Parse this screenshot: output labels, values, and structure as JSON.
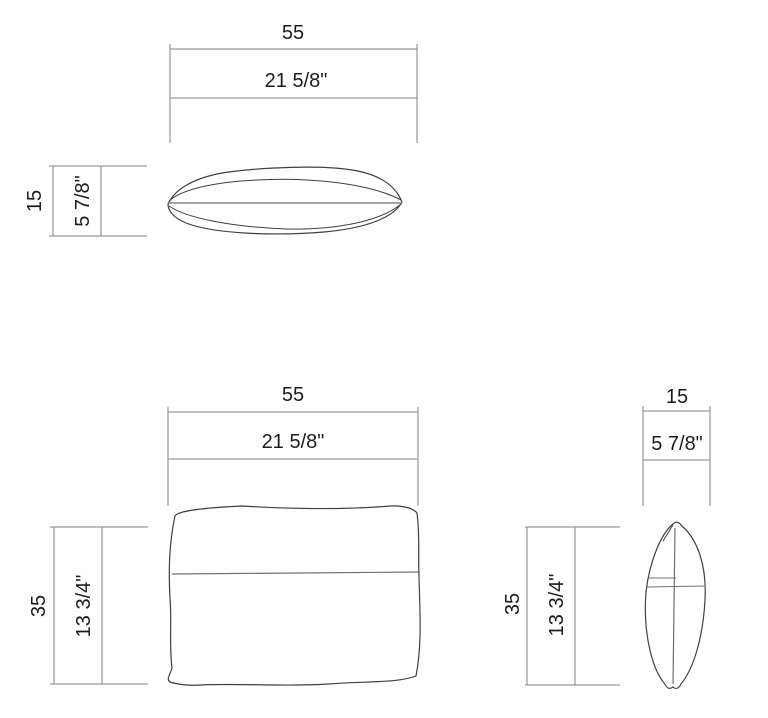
{
  "drawing": {
    "type": "technical-dimension-drawing",
    "subject": "rectangular cushion shown in top, front and side views",
    "colors": {
      "background": "#ffffff",
      "dimension_line": "#828282",
      "outline": "#404040",
      "seam_line": "#6f6f6f",
      "text": "#1c1c1c"
    },
    "views": {
      "top": {
        "name": "top view",
        "width_cm": "55",
        "width_in": "21 5/8\"",
        "depth_cm": "15",
        "depth_in": "5 7/8\""
      },
      "front": {
        "name": "front view",
        "width_cm": "55",
        "width_in": "21 5/8\"",
        "height_cm": "35",
        "height_in": "13 3/4\""
      },
      "side": {
        "name": "side view",
        "depth_cm": "15",
        "depth_in": "5 7/8\"",
        "height_cm": "35",
        "height_in": "13 3/4\""
      }
    }
  }
}
